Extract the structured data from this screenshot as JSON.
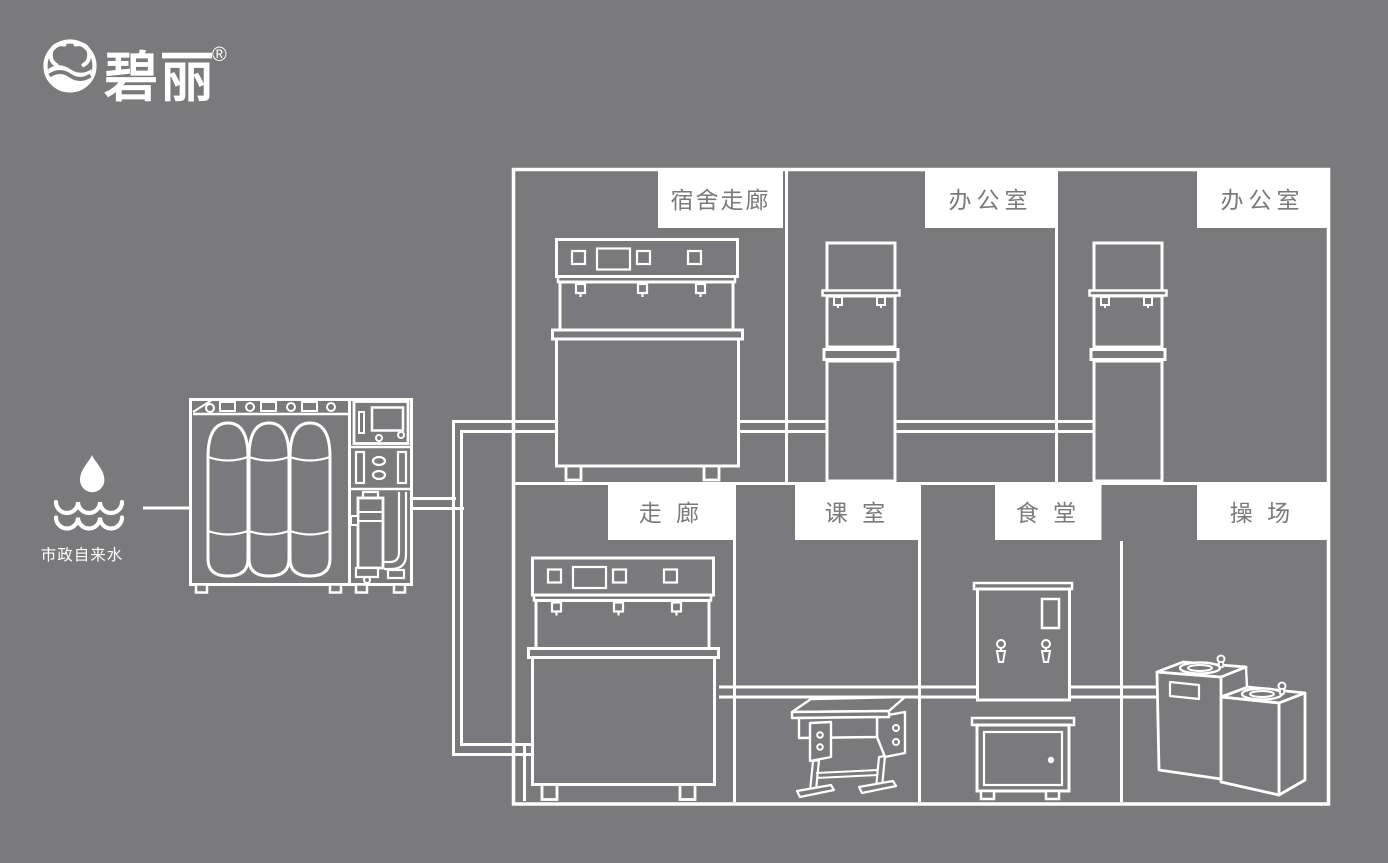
{
  "colors": {
    "background": "#7a7a7c",
    "line": "#ffffff",
    "label_bg": "#ffffff",
    "label_text": "#7a7a7c"
  },
  "brand": {
    "name": "碧丽",
    "registered_mark": "®",
    "logo_icon": "water-bowl-logo-icon"
  },
  "water_source": {
    "label": "市政自来水",
    "icon": "water-drop-over-waves-icon"
  },
  "rooms": {
    "top_row": [
      {
        "label": "宿舍走廊",
        "equipment": "three-tap-drinking-water-dispenser"
      },
      {
        "label": "办公室",
        "equipment": "two-tap-vertical-water-dispenser"
      },
      {
        "label": "办公室",
        "equipment": "two-tap-vertical-water-dispenser"
      }
    ],
    "bottom_row": [
      {
        "label": "走 廊",
        "equipment": "three-tap-drinking-water-dispenser"
      },
      {
        "label": "课 室",
        "equipment": "school-desk"
      },
      {
        "label": "食 堂",
        "equipment": "water-boiler-with-cabinet"
      },
      {
        "label": "操 场",
        "equipment": "two-basin-drinking-fountain"
      }
    ]
  },
  "equipment": {
    "treatment": "ro-water-treatment-machine",
    "piping": "water-supply-pipe-network"
  }
}
